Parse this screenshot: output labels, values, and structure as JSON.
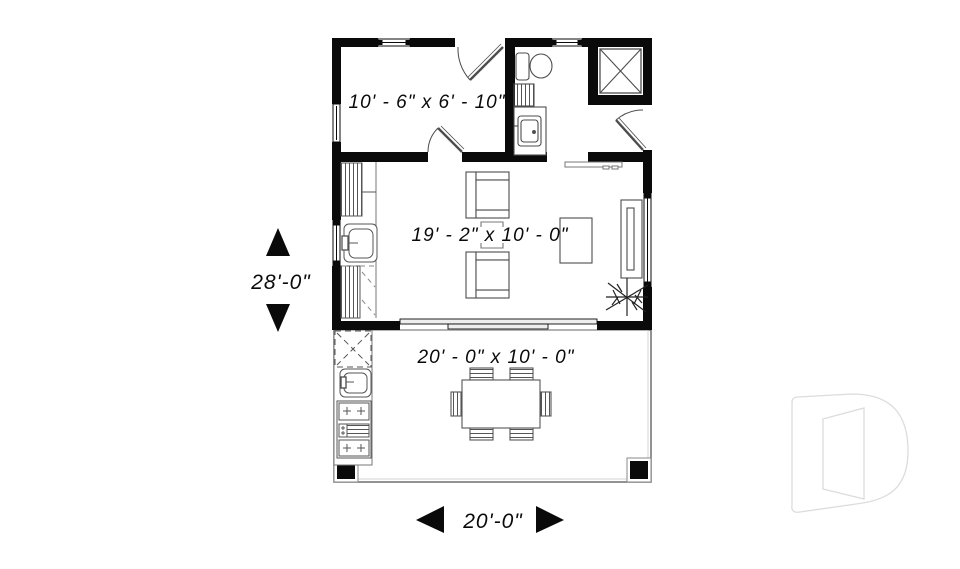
{
  "plan": {
    "type": "floor-plan",
    "rooms": [
      {
        "id": "bedroom",
        "dimension": "10' - 6\" x 6' - 10\""
      },
      {
        "id": "living-area",
        "dimension": "19' - 2\" x 10' - 0\""
      },
      {
        "id": "terrace",
        "dimension": "20' - 0\" x 10' - 0\""
      }
    ],
    "overall": {
      "depth_label": "28'-0\"",
      "width_label": "20'-0\""
    }
  },
  "labels": {
    "bedroom": "10' - 6\" x 6' - 10\"",
    "living": "19' - 2\" x 10' - 0\"",
    "terrace": "20' - 0\" x 10' - 0\"",
    "overall_depth": "28'-0\"",
    "overall_width": "20'-0\""
  },
  "colors": {
    "wall": "#0a0a0a",
    "fixture_line": "#4d4d4d",
    "light_line": "#8a8a8a",
    "watermark_stroke": "#dcdcdc",
    "background": "#ffffff"
  }
}
